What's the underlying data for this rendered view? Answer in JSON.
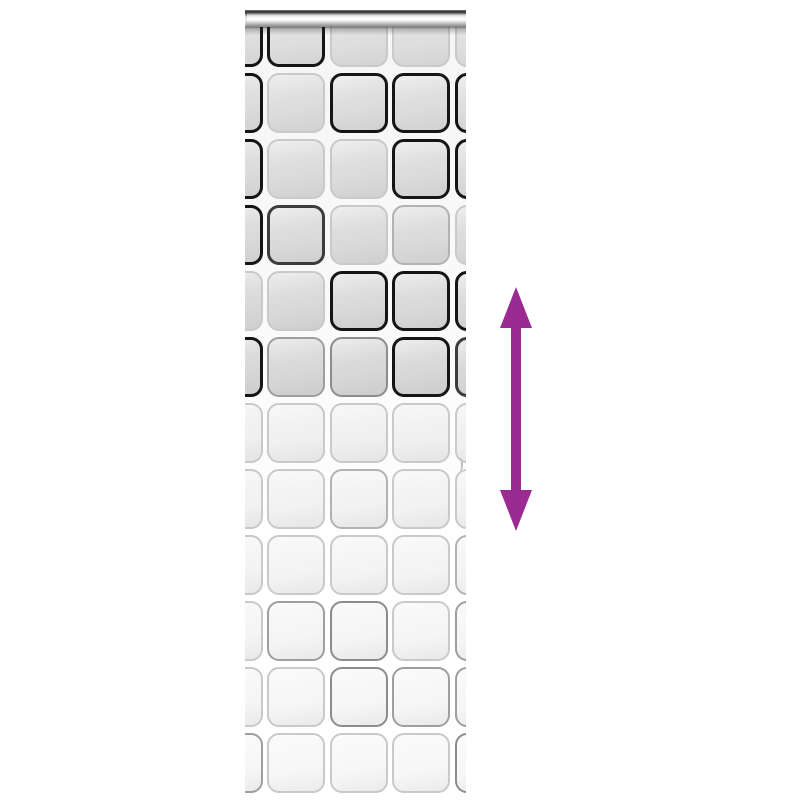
{
  "image": {
    "type": "product-photo",
    "subject": "Roller blind with rounded-square check pattern, chrome top roller and purple vertical double arrow indicating adjustable height",
    "background_color": "#ffffff"
  },
  "blind": {
    "frame": {
      "left": 245,
      "top": 10,
      "width": 221,
      "height": 790
    },
    "roller_bar": {
      "left": -7,
      "top": 0,
      "width": 241,
      "height": 17
    },
    "bar_shadow_top": 16,
    "grid": {
      "columns_left": [
        -40.5,
        22,
        84.5,
        147,
        209.5
      ],
      "cell_width": 58,
      "cell_height": 60,
      "row_pitch": 66,
      "first_row_top": -3,
      "corner_radius": 12,
      "rows": [
        {
          "fill": "#dedede",
          "borders": [
            "#151515",
            "#151515",
            "#c9c9c9",
            "#c9c9c9",
            "#c9c9c9"
          ]
        },
        {
          "fill": "#dcdcdc",
          "borders": [
            "#151515",
            "#c9c9c9",
            "#151515",
            "#151515",
            "#151515"
          ]
        },
        {
          "fill": "#dbdbdb",
          "borders": [
            "#151515",
            "#c9c9c9",
            "#c9c9c9",
            "#151515",
            "#151515"
          ]
        },
        {
          "fill": "#dadada",
          "borders": [
            "#151515",
            "#3c3c3c",
            "#c9c9c9",
            "#b2b2b2",
            "#c9c9c9"
          ]
        },
        {
          "fill": "#d9d9d9",
          "borders": [
            "#c9c9c9",
            "#c9c9c9",
            "#151515",
            "#151515",
            "#151515"
          ]
        },
        {
          "fill": "#d7d7d7",
          "borders": [
            "#151515",
            "#9e9e9e",
            "#8c8c8c",
            "#151515",
            "#3c3c3c"
          ]
        },
        {
          "fill": "#f0f0f0",
          "borders": [
            "#c9c9c9",
            "#c9c9c9",
            "#c9c9c9",
            "#c9c9c9",
            "#c9c9c9"
          ]
        },
        {
          "fill": "#f2f2f2",
          "borders": [
            "#c9c9c9",
            "#c9c9c9",
            "#b2b2b2",
            "#c9c9c9",
            "#c9c9c9"
          ]
        },
        {
          "fill": "#f4f4f4",
          "borders": [
            "#c9c9c9",
            "#c9c9c9",
            "#c9c9c9",
            "#c9c9c9",
            "#b2b2b2"
          ]
        },
        {
          "fill": "#f5f5f5",
          "borders": [
            "#c9c9c9",
            "#9e9e9e",
            "#8c8c8c",
            "#c9c9c9",
            "#9e9e9e"
          ]
        },
        {
          "fill": "#f6f6f6",
          "borders": [
            "#c9c9c9",
            "#c9c9c9",
            "#8c8c8c",
            "#9e9e9e",
            "#9e9e9e"
          ]
        },
        {
          "fill": "#f7f7f7",
          "borders": [
            "#9e9e9e",
            "#c9c9c9",
            "#c9c9c9",
            "#c9c9c9",
            "#8c8c8c"
          ]
        }
      ]
    },
    "edge_notch": {
      "left": 212,
      "top": 448
    }
  },
  "arrow": {
    "color": "#9b2a92",
    "left": 500,
    "top": 287,
    "width": 32,
    "height": 244,
    "points": "16,0 32,41 21,41 21,203 32,203 16,244 0,203 11,203 11,41 0,41"
  }
}
